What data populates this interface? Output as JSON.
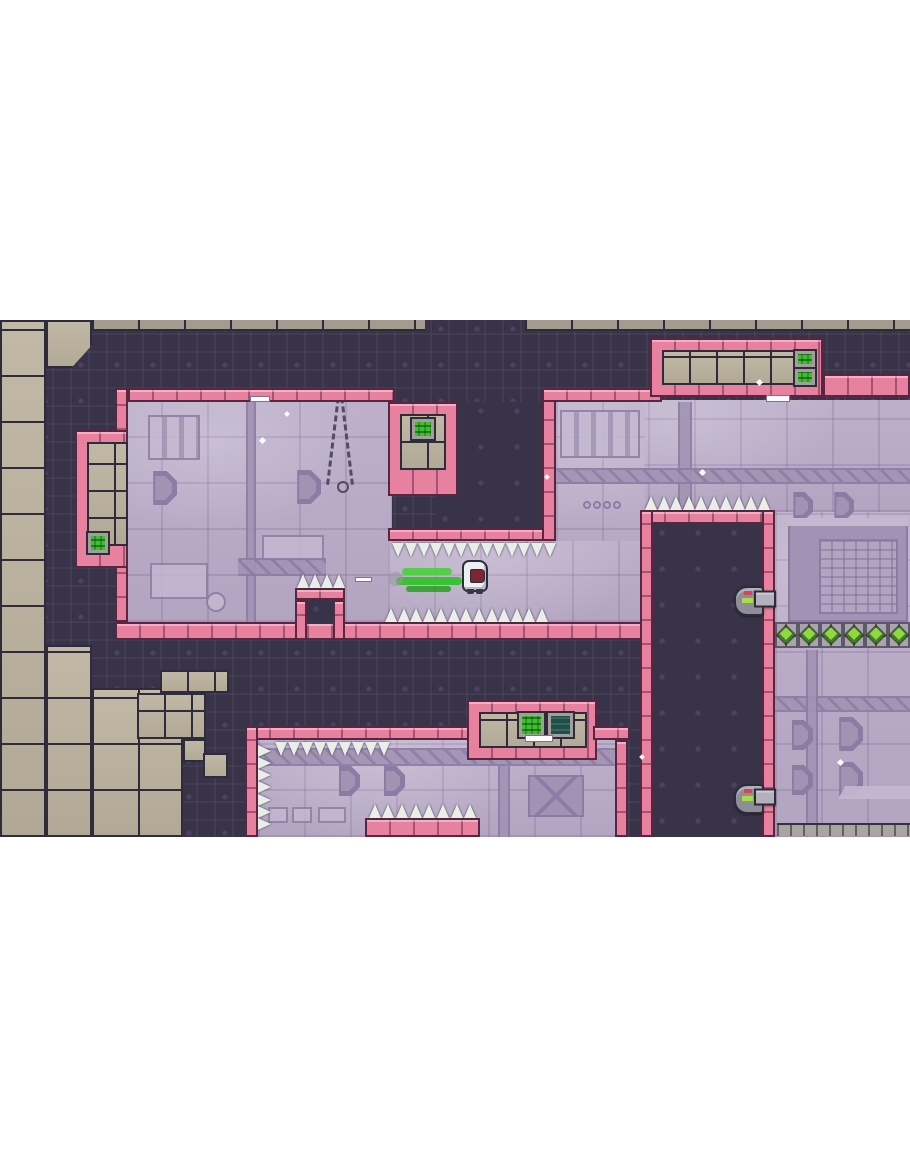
{
  "meta": {
    "scene": "pixel-art platformer level, letterboxed game viewport",
    "viewport": {
      "x": 0,
      "y": 320,
      "w": 910,
      "h": 517
    },
    "player_state": {
      "facing": "right",
      "dashing": true,
      "trail_color": "green"
    }
  },
  "palette": {
    "terrain": "#393349",
    "terrain-line": "#4a4360",
    "room": "#b3a5c1",
    "room-light": "#c5b8d1",
    "room-light2": "#beb0cb",
    "room-dark": "#a293b4",
    "room-darker": "#8d7ba3",
    "pink": "#e8809f",
    "pink-dark": "#5a2540",
    "tan": "#b2a896",
    "tan-light": "#c2b8a6",
    "tan-gray": "#a39b8e",
    "outline": "#2e2c3a",
    "spike": "#e9eee9",
    "screen-green": "#3fbe31",
    "screen-teal": "#1e4f49",
    "screen-frame": "#a19e9b",
    "gem": "#8fd83f",
    "gem-dark": "#3f7d1f",
    "gray-block": "#aaa5a0",
    "turret": "#908d9a",
    "turret-light": "#b4b1bc",
    "light-red": "#d84655",
    "light-green": "#a8dc4a",
    "player": "#edf0f0",
    "visor": "#7e2433",
    "trail": "#49d13b",
    "trail-dark": "#35c12c",
    "trail-dark2": "#2a9e24"
  },
  "level": {
    "elements": [
      {
        "t": "room",
        "n": "room-top-left",
        "x": 115,
        "y": 82,
        "w": 277,
        "h": 220
      },
      {
        "t": "room",
        "n": "room-top-right",
        "x": 556,
        "y": 80,
        "w": 354,
        "h": 112
      },
      {
        "t": "room",
        "n": "room-center-column",
        "x": 556,
        "y": 80,
        "w": 89,
        "h": 222
      },
      {
        "t": "room",
        "n": "corridor-room",
        "x": 388,
        "y": 221,
        "w": 265,
        "h": 81
      },
      {
        "t": "room",
        "n": "room-right-lower",
        "x": 775,
        "y": 192,
        "w": 135,
        "h": 325
      },
      {
        "t": "room",
        "n": "room-bottom-center",
        "x": 258,
        "y": 420,
        "w": 360,
        "h": 97
      },
      {
        "t": "slats",
        "x": 148,
        "y": 95,
        "w": 52,
        "h": 45
      },
      {
        "t": "pipeV",
        "x": 246,
        "y": 82,
        "w": 10,
        "h": 220
      },
      {
        "t": "octagon",
        "x": 143,
        "y": 151,
        "w": 34,
        "h": 34
      },
      {
        "t": "octagon",
        "x": 287,
        "y": 150,
        "w": 34,
        "h": 34
      },
      {
        "t": "sq",
        "x": 262,
        "y": 215,
        "w": 62,
        "h": 26
      },
      {
        "t": "pipeH",
        "cls": "hatch",
        "x": 238,
        "y": 238,
        "w": 88,
        "h": 18
      },
      {
        "t": "sq",
        "x": 150,
        "y": 243,
        "w": 58,
        "h": 36
      },
      {
        "t": "gauge",
        "x": 206,
        "y": 272,
        "w": 20,
        "h": 20
      },
      {
        "t": "chain",
        "x": 326,
        "y": 68,
        "w": 26,
        "h": 105
      },
      {
        "t": "slats",
        "x": 560,
        "y": 90,
        "w": 80,
        "h": 48
      },
      {
        "t": "pipeV",
        "x": 678,
        "y": 82,
        "w": 14,
        "h": 108
      },
      {
        "t": "pipeH",
        "cls": "hatch",
        "x": 556,
        "y": 148,
        "w": 354,
        "h": 16
      },
      {
        "t": "octagon",
        "x": 785,
        "y": 172,
        "w": 28,
        "h": 28
      },
      {
        "t": "octagon",
        "x": 826,
        "y": 172,
        "w": 28,
        "h": 28
      },
      {
        "t": "circles4",
        "x": 583,
        "y": 180,
        "w": 38,
        "h": 10
      },
      {
        "t": "cube",
        "x": 788,
        "y": 198,
        "w": 120,
        "h": 104
      },
      {
        "t": "pipeH",
        "cls": "hatch",
        "x": 775,
        "y": 376,
        "w": 135,
        "h": 16
      },
      {
        "t": "pipeV",
        "x": 806,
        "y": 330,
        "w": 12,
        "h": 187
      },
      {
        "t": "octagon",
        "x": 783,
        "y": 400,
        "w": 30,
        "h": 30
      },
      {
        "t": "octagon",
        "x": 829,
        "y": 397,
        "w": 34,
        "h": 34
      },
      {
        "t": "octagon",
        "x": 783,
        "y": 445,
        "w": 30,
        "h": 30
      },
      {
        "t": "octagon",
        "x": 829,
        "y": 442,
        "w": 34,
        "h": 34
      },
      {
        "t": "ledge",
        "x": 838,
        "y": 466,
        "w": 72,
        "h": 13
      },
      {
        "t": "pipeH",
        "cls": "hatch",
        "x": 258,
        "y": 428,
        "w": 357,
        "h": 18
      },
      {
        "t": "octagon",
        "x": 330,
        "y": 446,
        "w": 30,
        "h": 30
      },
      {
        "t": "octagon",
        "x": 375,
        "y": 446,
        "w": 30,
        "h": 30
      },
      {
        "t": "pipeV",
        "x": 498,
        "y": 446,
        "w": 12,
        "h": 71
      },
      {
        "t": "xpanel",
        "x": 528,
        "y": 455,
        "w": 56,
        "h": 42
      },
      {
        "t": "sq",
        "x": 268,
        "y": 487,
        "w": 20,
        "h": 16
      },
      {
        "t": "sq",
        "x": 292,
        "y": 487,
        "w": 20,
        "h": 16
      },
      {
        "t": "sq",
        "x": 318,
        "y": 487,
        "w": 28,
        "h": 16
      },
      {
        "t": "dark",
        "n": "terrain-overhang",
        "x": 436,
        "y": 82,
        "w": 120,
        "h": 126
      },
      {
        "t": "dark",
        "n": "terrain-tower",
        "x": 653,
        "y": 204,
        "w": 109,
        "h": 313
      },
      {
        "t": "tan",
        "x": 0,
        "y": 0,
        "w": 46,
        "h": 517
      },
      {
        "t": "tan",
        "cls": "chip",
        "x": 46,
        "y": 0,
        "w": 46,
        "h": 48
      },
      {
        "t": "tan",
        "x": 46,
        "y": 325,
        "w": 46,
        "h": 192
      },
      {
        "t": "tan",
        "x": 92,
        "y": 368,
        "w": 91,
        "h": 149
      },
      {
        "t": "tan-sm",
        "x": 160,
        "y": 350,
        "w": 69,
        "h": 23
      },
      {
        "t": "tan-sm",
        "x": 137,
        "y": 373,
        "w": 69,
        "h": 46
      },
      {
        "t": "tan-sm",
        "x": 183,
        "y": 419,
        "w": 23,
        "h": 23
      },
      {
        "t": "tan-sm",
        "x": 203,
        "y": 433,
        "w": 25,
        "h": 25
      },
      {
        "t": "toprow",
        "x": 92,
        "y": 0,
        "w": 333,
        "h": 11
      },
      {
        "t": "toprow",
        "x": 525,
        "y": 0,
        "w": 385,
        "h": 11
      },
      {
        "t": "pink",
        "n": "room1-top-border",
        "x": 128,
        "y": 68,
        "w": 267,
        "h": 14
      },
      {
        "t": "pinkV",
        "n": "room1-left-wall",
        "x": 115,
        "y": 68,
        "w": 13,
        "h": 234
      },
      {
        "t": "pink",
        "n": "corridor-floor",
        "x": 115,
        "y": 302,
        "w": 538,
        "h": 18
      },
      {
        "t": "pink",
        "n": "alcove-left-frame",
        "x": 75,
        "y": 110,
        "w": 53,
        "h": 138
      },
      {
        "t": "tan-sm",
        "x": 87,
        "y": 122,
        "w": 41,
        "h": 104
      },
      {
        "t": "screen",
        "x": 88,
        "y": 213,
        "w": 20,
        "h": 20
      },
      {
        "t": "pink",
        "n": "alcove-upper-frame",
        "x": 388,
        "y": 82,
        "w": 70,
        "h": 94
      },
      {
        "t": "tan-sm",
        "x": 400,
        "y": 94,
        "w": 46,
        "h": 56
      },
      {
        "t": "screen",
        "x": 412,
        "y": 99,
        "w": 22,
        "h": 20
      },
      {
        "t": "pink",
        "n": "corridor-ceiling-bar",
        "x": 388,
        "y": 208,
        "w": 168,
        "h": 13
      },
      {
        "t": "pinkV",
        "n": "room2-left-wall",
        "x": 542,
        "y": 68,
        "w": 14,
        "h": 153
      },
      {
        "t": "pink",
        "n": "room2-top-border",
        "x": 542,
        "y": 68,
        "w": 120,
        "h": 14
      },
      {
        "t": "pink",
        "n": "top-right-frame",
        "x": 650,
        "y": 18,
        "w": 173,
        "h": 59
      },
      {
        "t": "tan-sm",
        "x": 662,
        "y": 30,
        "w": 149,
        "h": 35
      },
      {
        "t": "screen",
        "x": 795,
        "y": 31,
        "w": 20,
        "h": 16
      },
      {
        "t": "screen",
        "x": 795,
        "y": 49,
        "w": 20,
        "h": 16
      },
      {
        "t": "pink",
        "n": "top-right-border",
        "x": 823,
        "y": 54,
        "w": 87,
        "h": 23
      },
      {
        "t": "pink",
        "n": "tower-top-border",
        "x": 640,
        "y": 190,
        "w": 135,
        "h": 14
      },
      {
        "t": "pinkV",
        "n": "tower-left-wall",
        "x": 640,
        "y": 190,
        "w": 13,
        "h": 327
      },
      {
        "t": "pinkV",
        "n": "tower-right-wall",
        "x": 762,
        "y": 190,
        "w": 13,
        "h": 327
      },
      {
        "t": "pink",
        "n": "bottom-room-top-border",
        "x": 245,
        "y": 406,
        "w": 225,
        "h": 14
      },
      {
        "t": "pink",
        "n": "bottom-box-frame",
        "x": 467,
        "y": 380,
        "w": 130,
        "h": 60
      },
      {
        "t": "tan-sm",
        "x": 479,
        "y": 392,
        "w": 108,
        "h": 36
      },
      {
        "t": "screen",
        "x": 519,
        "y": 393,
        "w": 25,
        "h": 24
      },
      {
        "t": "screenDark",
        "x": 548,
        "y": 393,
        "w": 25,
        "h": 24
      },
      {
        "t": "pink",
        "n": "bottom-room-border-seg",
        "x": 593,
        "y": 406,
        "w": 37,
        "h": 14
      },
      {
        "t": "pinkV",
        "n": "bottom-room-right-wall",
        "x": 615,
        "y": 420,
        "w": 13,
        "h": 97
      },
      {
        "t": "pinkV",
        "n": "bottom-room-left-wall",
        "x": 245,
        "y": 406,
        "w": 13,
        "h": 111
      },
      {
        "t": "pink",
        "n": "floor-spike-base",
        "x": 365,
        "y": 498,
        "w": 115,
        "h": 19
      },
      {
        "t": "pink",
        "n": "pedestal-top",
        "x": 295,
        "y": 268,
        "w": 50,
        "h": 12
      },
      {
        "t": "pinkV",
        "n": "pedestal-leg",
        "x": 295,
        "y": 280,
        "w": 12,
        "h": 40
      },
      {
        "t": "pinkV",
        "n": "pedestal-leg",
        "x": 333,
        "y": 280,
        "w": 12,
        "h": 40
      },
      {
        "t": "dark",
        "n": "pedestal-opening",
        "x": 307,
        "y": 280,
        "w": 26,
        "h": 24
      },
      {
        "t": "spikes",
        "dir": "down",
        "x": 392,
        "y": 221,
        "w": 164,
        "h": 16
      },
      {
        "t": "spikes",
        "dir": "up",
        "x": 385,
        "y": 286,
        "w": 163,
        "h": 16
      },
      {
        "t": "spikes",
        "dir": "up",
        "x": 297,
        "y": 254,
        "w": 46,
        "h": 14
      },
      {
        "t": "spikes",
        "dir": "up",
        "x": 645,
        "y": 176,
        "w": 125,
        "h": 14
      },
      {
        "t": "spikes",
        "dir": "down",
        "x": 275,
        "y": 420,
        "w": 115,
        "h": 16
      },
      {
        "t": "spikes",
        "dir": "right",
        "x": 258,
        "y": 425,
        "w": 15,
        "h": 85
      },
      {
        "t": "spikes",
        "dir": "up",
        "x": 368,
        "y": 482,
        "w": 109,
        "h": 16
      },
      {
        "t": "dash",
        "x": 250,
        "y": 76,
        "w": 20,
        "h": 6
      },
      {
        "t": "dash",
        "x": 766,
        "y": 75,
        "w": 24,
        "h": 7
      },
      {
        "t": "dash",
        "x": 355,
        "y": 257,
        "w": 17,
        "h": 5
      },
      {
        "t": "dash",
        "x": 525,
        "y": 415,
        "w": 28,
        "h": 7
      },
      {
        "t": "sparkle",
        "x": 260,
        "y": 118,
        "w": 5,
        "h": 5
      },
      {
        "t": "sparkle",
        "x": 700,
        "y": 150,
        "w": 5,
        "h": 5
      },
      {
        "t": "sparkle",
        "x": 545,
        "y": 155,
        "w": 4,
        "h": 4
      },
      {
        "t": "sparkle",
        "x": 640,
        "y": 435,
        "w": 4,
        "h": 4
      },
      {
        "t": "sparkle",
        "x": 838,
        "y": 440,
        "w": 5,
        "h": 5
      },
      {
        "t": "sparkle",
        "x": 285,
        "y": 92,
        "w": 4,
        "h": 4
      },
      {
        "t": "sparkle",
        "x": 757,
        "y": 60,
        "w": 5,
        "h": 5
      },
      {
        "t": "gems",
        "n": "gem-block-row",
        "x": 775,
        "y": 302,
        "w": 135,
        "h": 26,
        "count": 6
      },
      {
        "t": "grayrow",
        "x": 777,
        "y": 503,
        "w": 133,
        "h": 13
      },
      {
        "t": "turret",
        "x": 734,
        "y": 266,
        "w": 42,
        "h": 26
      },
      {
        "t": "turret",
        "x": 734,
        "y": 464,
        "w": 42,
        "h": 26
      },
      {
        "t": "trail",
        "x": 396,
        "y": 246,
        "w": 72,
        "h": 28
      },
      {
        "t": "player",
        "x": 462,
        "y": 240,
        "w": 26,
        "h": 32
      }
    ]
  }
}
